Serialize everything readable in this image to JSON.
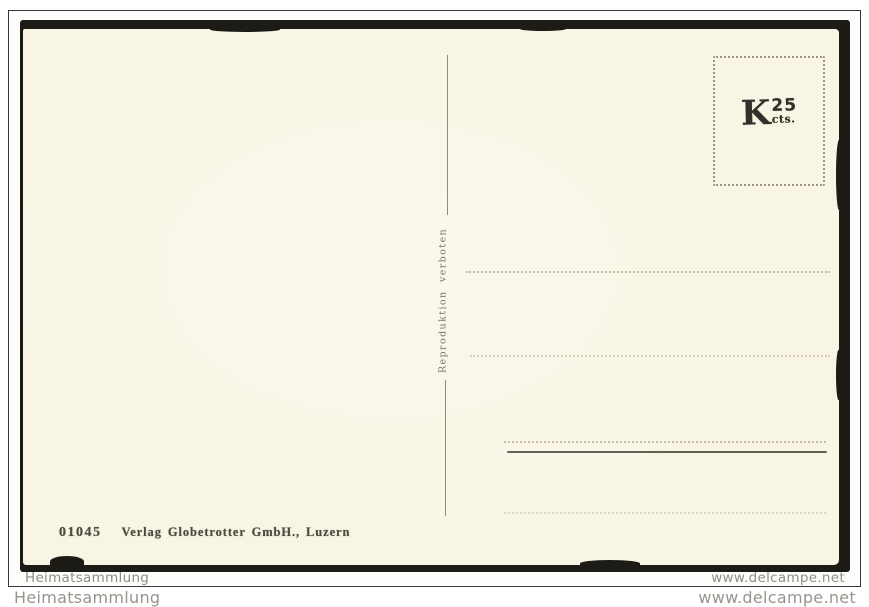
{
  "colors": {
    "page_bg": "#ffffff",
    "frame_border": "#38383a",
    "scan_black": "#1c1b16",
    "card_cream": "#f8f5e4",
    "ink": "#4e4a40",
    "faint_line": "#b5aa8a",
    "watermark_gray": "#8f8d86"
  },
  "watermarks": {
    "inner_left": "Heimatsammlung",
    "inner_right": "www.delcampe.net",
    "outer_left": "Heimatsammlung",
    "outer_right": "www.delcampe.net"
  },
  "postcard": {
    "stamp_box": {
      "currency": "K",
      "value": "25",
      "unit": "cts."
    },
    "note_vertical": "Reproduktion verboten",
    "publisher_number": "01045",
    "publisher_name": "Verlag Globetrotter GmbH., Luzern"
  }
}
